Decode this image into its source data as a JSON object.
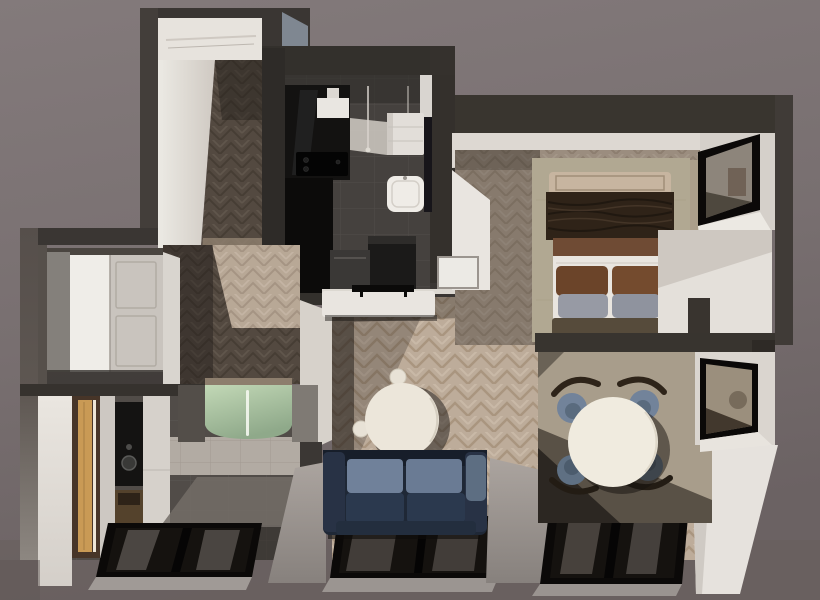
{
  "scene": {
    "kind": "3d-floor-plan-render",
    "description": "Top-down 3D architectural render of a one-bedroom apartment, no visible text",
    "view": "bird's-eye dollhouse view",
    "text_content": "none"
  },
  "colors": {
    "background_top": "#837a7b",
    "background_bottom": "#6b6263",
    "ground": "#696160",
    "wall_dark": "#3a3633",
    "wall_dark2": "#33302c",
    "wall_concrete": "#5e5752",
    "wall_blue_face": "#7f8791",
    "wall_white": "#e7e3dd",
    "wall_white_dim": "#cfcac4",
    "white_wall_bright": "#e6e2dd",
    "ceiling_band": "#ddd8d2",
    "floor_wood_light": "#bdac9a",
    "floor_wood_mid": "#8d7e6d",
    "floor_wood_dark": "#534940",
    "kitchen_floor": "#45413e",
    "bath_floor": "#514c48",
    "tile_beige": "#b2aba3",
    "cabinet_black": "#131211",
    "cabinet_black_deep": "#0c0b0a",
    "cooktop_black": "#040404",
    "hood_white": "#e9e6e1",
    "fridge_white": "#e2ded9",
    "sink_white": "#efece7",
    "appliance_dark": "#1b1a19",
    "oven_gray": "#3a3836",
    "sideboard_white": "#e9e5e0",
    "tv_black": "#0b0a09",
    "sofa_body": "#1f2836",
    "sofa_arm": "#283245",
    "sofa_arm_light": "#5d6e82",
    "sofa_back_cushion": "#70819a",
    "sofa_seat": "#2b394e",
    "coffee_table": "#ece6da",
    "stool_cream": "#e8e2d6",
    "dining_rug": "#a89d8b",
    "dining_table": "#f0ebdf",
    "chair_slate": "#72839a",
    "chair_slate_dark": "#5f7083",
    "chair_back_wood": "#2e2419",
    "bedroom_rug": "#b1a892",
    "bedroom_plaster": "#ab9e8b",
    "bed_headboard": "#c7b5a0",
    "bed_blanket": "#2f2318",
    "bed_mid_band": "#6f4b34",
    "bed_sheet": "#e9e5df",
    "pillow_brown": "#6b4429",
    "pillow_brown2": "#744b2e",
    "pillow_gray": "#979aa4",
    "pillow_gray2": "#8f939e",
    "bed_bench": "#564b3b",
    "wardrobe_bright": "#efede8",
    "wardrobe_door": "#c9c4be",
    "wardrobe_gray_face": "#84807b",
    "vanity_wood_dark": "#473528",
    "vanity_wood_light": "#c99a55",
    "mirror_black": "#141312",
    "niche_wood": "#54422c",
    "vanity_white": "#cdc8c2",
    "shower_glass_light": "#c2d8b6",
    "shower_glass_dark": "#8fa98a",
    "window_glass": "#15120f",
    "window_frame": "#0b0908",
    "glass_reflection": "#8d8781",
    "glass_tilt": "#736d67",
    "ledge_gray": "#9d9792",
    "sill_gray": "#a09a96",
    "closet_box_white": "#eceae5"
  },
  "rooms": [
    {
      "id": "entry-corridor",
      "label": "Entry corridor",
      "floor": "dark herringbone wood"
    },
    {
      "id": "kitchen",
      "label": "Kitchen",
      "floor": "dark gray tile"
    },
    {
      "id": "bedroom",
      "label": "Bedroom",
      "floor": "light herringbone wood with sage rug"
    },
    {
      "id": "hallway-wardrobe",
      "label": "Hallway with wardrobe",
      "floor": "dark herringbone wood"
    },
    {
      "id": "bathroom",
      "label": "Bathroom",
      "floor": "dark tile, beige tile wall, green glass shower"
    },
    {
      "id": "living-room",
      "label": "Living room",
      "floor": "light herringbone wood"
    },
    {
      "id": "dining-area",
      "label": "Dining area",
      "floor": "wood with large beige rug"
    }
  ],
  "furniture": [
    {
      "room": "kitchen",
      "items": [
        "black upper cabinets",
        "black countertop",
        "cooktop",
        "white range hood",
        "pendant lamps",
        "white fridge cabinet",
        "white sink",
        "dark appliance",
        "gray oven box"
      ]
    },
    {
      "room": "living-room",
      "items": [
        "white media sideboard",
        "wall TV",
        "round cream coffee table",
        "two cream stools",
        "navy two-seat sofa with slate cushions"
      ]
    },
    {
      "room": "dining-area",
      "items": [
        "round white dining table",
        "four slate-blue chairs with dark wood backs",
        "beige area rug"
      ]
    },
    {
      "room": "bedroom",
      "items": [
        "double bed with dark brown throw",
        "tan headboard",
        "two brown pillows",
        "two gray pillows",
        "foot bench",
        "sage rug",
        "white closet box"
      ]
    },
    {
      "room": "hallway-wardrobe",
      "items": [
        "white built-in wardrobe with paneled doors"
      ]
    },
    {
      "room": "bathroom",
      "items": [
        "wood tall cabinet with LED strip",
        "black mirror vanity with round basin",
        "wood niche shelf",
        "curved green glass shower"
      ]
    },
    {
      "room": "windows",
      "items": [
        "bedroom side window",
        "dining side window",
        "bathroom floor-level window",
        "living floor-level window",
        "dining floor-level window"
      ]
    }
  ]
}
